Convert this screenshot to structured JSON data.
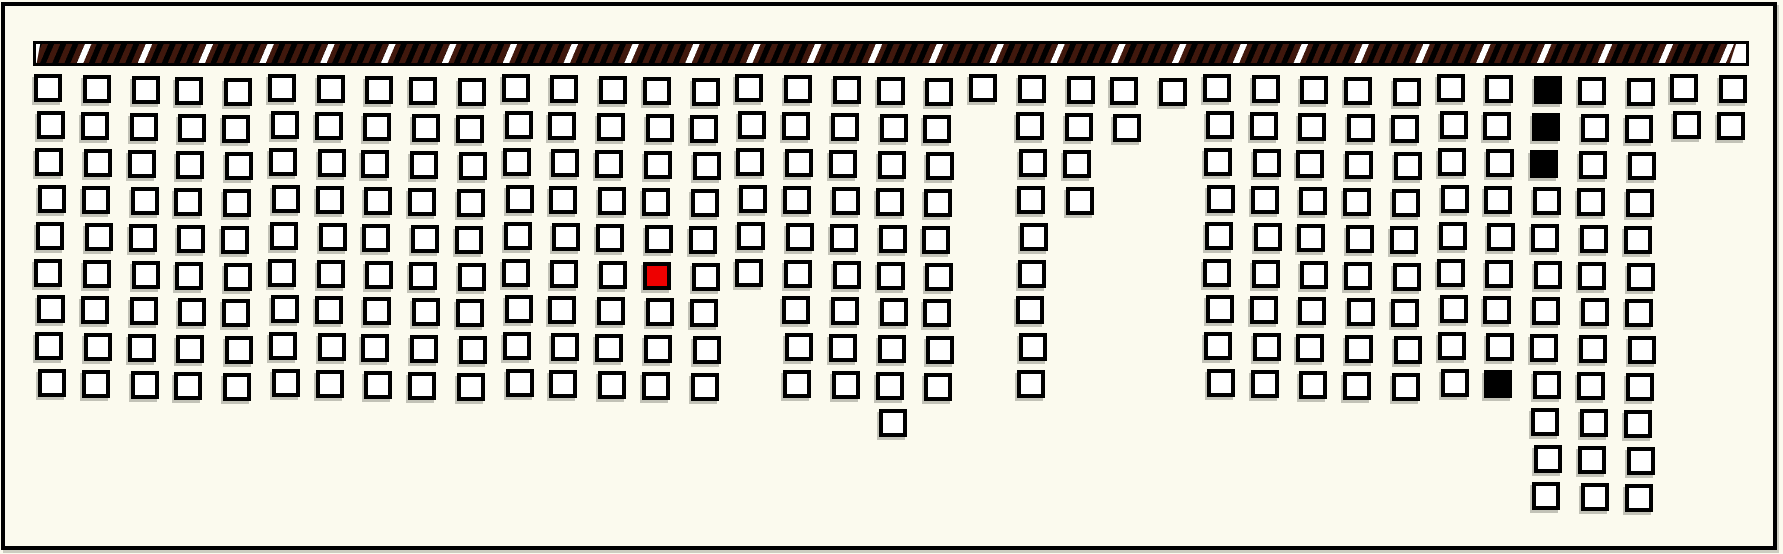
{
  "diagram": {
    "description": "Map of outlined square cells arranged in a gapped grid beneath a diagonally hatched bar; one red cell, four black cells",
    "canvas": {
      "width": 1783,
      "height": 554,
      "background": "#FBFAEE",
      "border_color": "#000000",
      "border_width": 4
    },
    "hatched_bar": {
      "x": 33,
      "y": 41,
      "width": 1716,
      "height": 25,
      "background": "#000000",
      "stripe_dark": "#40180D",
      "stripe_light": "#FFFFFF",
      "border_color": "#000000"
    },
    "grid": {
      "columns": 37,
      "rows": 12,
      "origin_x": 36,
      "origin_y": 76,
      "col_pitch": 46.75,
      "row_pitch": 36.9,
      "cell_size": 28,
      "cell_border_width": 4,
      "cell_border_color": "#000000",
      "shadow_color": "rgba(110,110,100,0.40)",
      "states": {
        "1": {
          "name": "open",
          "fill": "#FFFFFF"
        },
        "B": {
          "name": "filled-black",
          "fill": "#000000"
        },
        "R": {
          "name": "filled-red",
          "fill": "#EE0000"
        }
      },
      "matrix": [
        "11111111111111111111111111111111B1111",
        "11111111111111111111011101111111B1111",
        "11111111111111111111011001111111B1100",
        "1111111111111111111101100111111111100",
        "1111111111111111111101000111111111100",
        "1111111111111R11111101000111111111100",
        "1111111111111110111101000111111111100",
        "1111111111111110111101000111111111100",
        "1111111111111110111101000111111B11100",
        "0000000000000000001000000000000011100",
        "0000000000000000000000000000000011100",
        "0000000000000000000000000000000011100"
      ]
    },
    "counts": {
      "total_cells": 298,
      "open_cells": 293,
      "black_cells": 4,
      "red_cells": 1
    }
  }
}
